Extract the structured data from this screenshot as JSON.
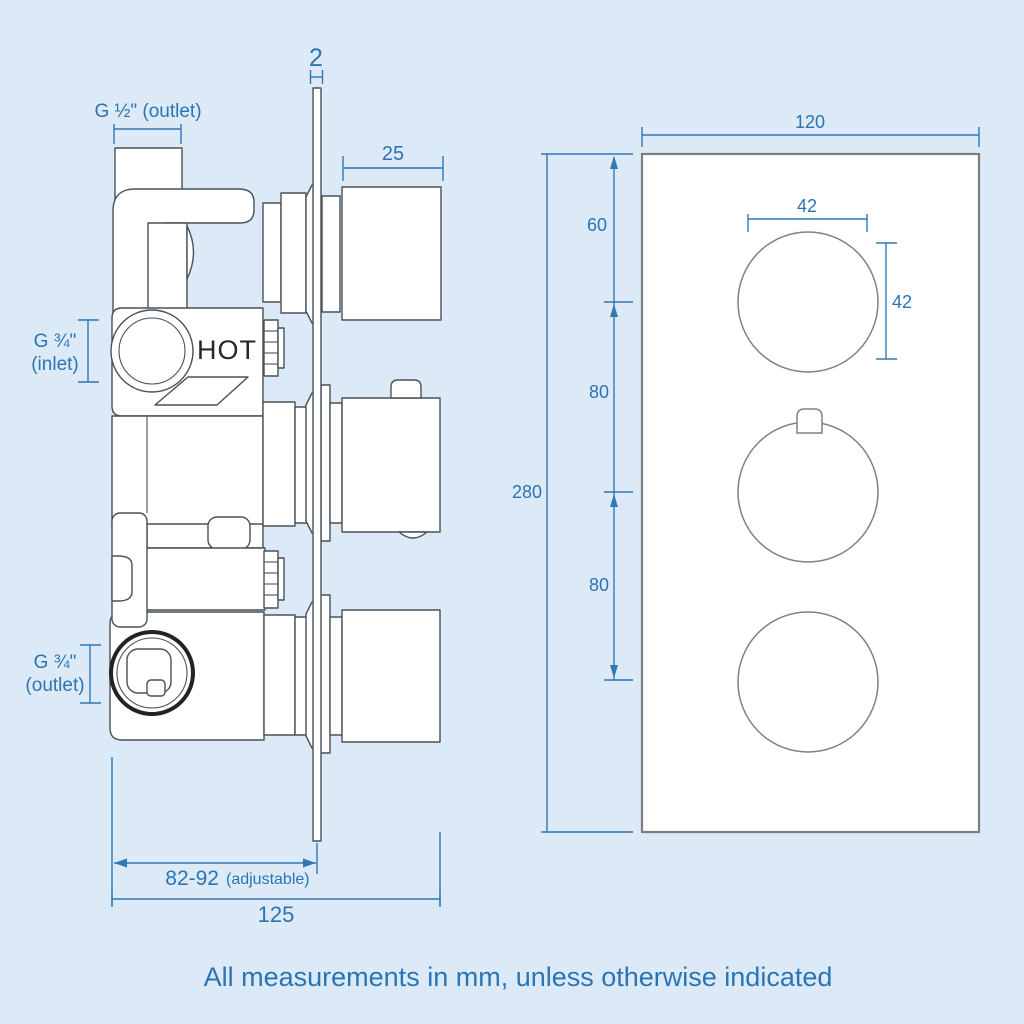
{
  "note": "All measurements in mm, unless otherwise indicated",
  "colors": {
    "background": "#dce9f7",
    "dimension_blue": "#2e79b6",
    "drawing_line": "#4a5157"
  },
  "side_view": {
    "labels": {
      "plate_thickness": "2",
      "top_outlet": "G ½\" (outlet)",
      "knob_depth": "25",
      "inlet_line1": "G ¾\"",
      "inlet_line2": "(inlet)",
      "hot_marking": "HOT",
      "bottom_outlet_line1": "G ¾\"",
      "bottom_outlet_line2": "(outlet)",
      "wall_depth_value": "82-92",
      "wall_depth_note": "(adjustable)",
      "total_depth": "125"
    }
  },
  "front_view": {
    "labels": {
      "plate_width": "120",
      "plate_height": "280",
      "top_dial_offset": "60",
      "dial_spacing_upper": "80",
      "dial_spacing_lower": "80",
      "dial_diameter_w": "42",
      "dial_diameter_h": "42"
    }
  }
}
